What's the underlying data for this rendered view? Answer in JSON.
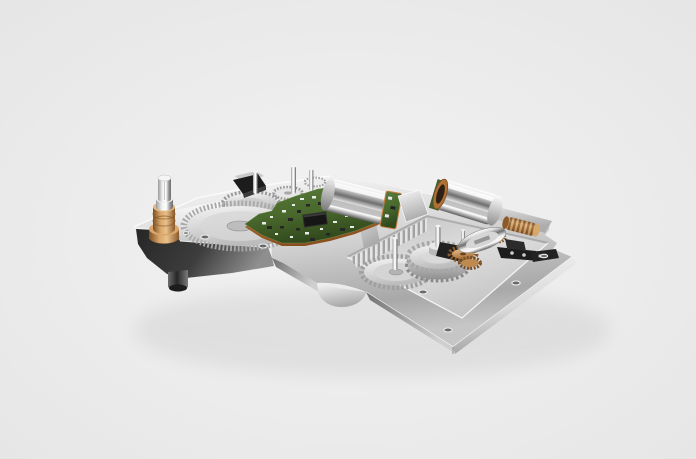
{
  "image": {
    "alt": "3D studio render of a compact precision gear-drive actuator assembly: an aluminium baseplate carrying spur gears, a green control PCB with an IC, two chrome DC motors, a brass worm gear and pinions, and a brass bushing with a steel output shaft",
    "type": "product-render"
  },
  "palette": {
    "background_inner": "#f3f3f3",
    "background_outer": "#e5e5e5",
    "plate_highlight": "#fafafa",
    "plate_mid": "#d4d4d4",
    "plate_shadow": "#a8a8a8",
    "dark_face": "#262626",
    "dark_face_light": "#8f8f8f",
    "chrome_light": "#ffffff",
    "chrome_mid": "#6e6e6e",
    "chrome_dark": "#5a5a5a",
    "brass_light": "#e9c08b",
    "brass_mid": "#b9854d",
    "brass_dark": "#7a4f26",
    "copper": "#c97f3e",
    "pcb_green": "#49682c",
    "pcb_green_dark": "#31491d",
    "ic_black": "#161616"
  },
  "components": [
    {
      "id": "baseplate",
      "label": "machined aluminium baseplate"
    },
    {
      "id": "output-shaft",
      "label": "steel output shaft"
    },
    {
      "id": "brass-bushing",
      "label": "brass bushing"
    },
    {
      "id": "main-gear",
      "label": "large fine-toothed ring gear"
    },
    {
      "id": "ribbed-gear",
      "label": "ribbed crown gear"
    },
    {
      "id": "control-pcb",
      "label": "green control PCB"
    },
    {
      "id": "ic-chip",
      "label": "IC chip"
    },
    {
      "id": "dc-motor-front",
      "label": "chrome DC motor (center)"
    },
    {
      "id": "dc-motor-rear",
      "label": "chrome DC motor (right)"
    },
    {
      "id": "worm-gear",
      "label": "brass worm gear"
    },
    {
      "id": "brass-pinions",
      "label": "brass pinion stack"
    },
    {
      "id": "pocket-gear-small",
      "label": "flat spur gear"
    },
    {
      "id": "pocket-gear-large",
      "label": "stepped spur gear with hub"
    },
    {
      "id": "gear-pocket",
      "label": "recessed gear pocket"
    },
    {
      "id": "mounting-foot",
      "label": "mounting foot standoff"
    },
    {
      "id": "screw-holes",
      "label": "mounting screw holes"
    }
  ]
}
